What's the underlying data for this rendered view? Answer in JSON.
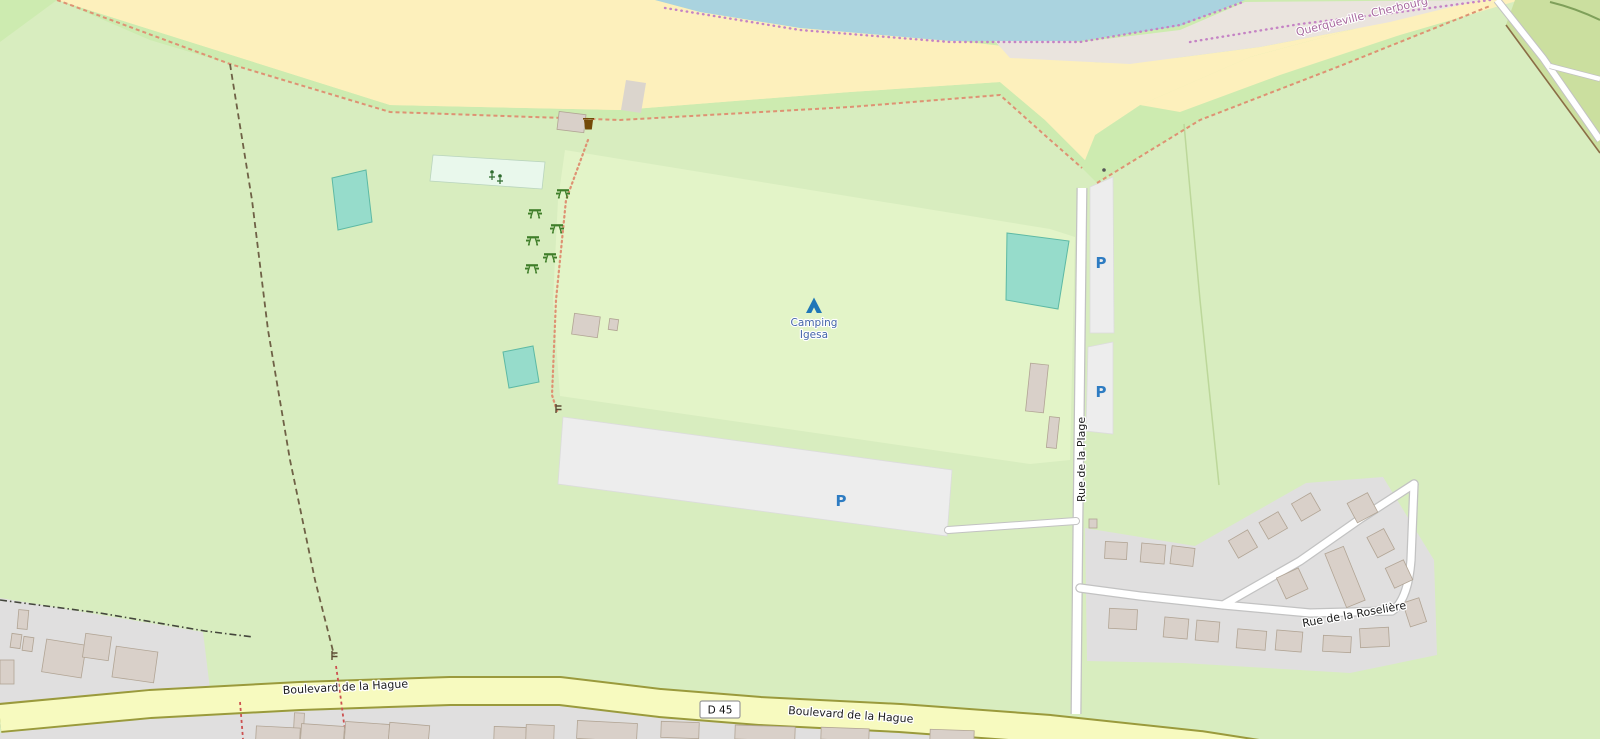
{
  "map": {
    "labels": {
      "querqueville": "Querqueville",
      "cherbourg": "Cherbourg",
      "camping_line1": "Camping",
      "camping_line2": "Igesa",
      "rue_plage": "Rue de la Plage",
      "rue_roseliere": "Rue de la Roselière",
      "blvd_hague_west": "Boulevard de la Hague",
      "blvd_hague_east": "Boulevard de la Hague",
      "route_ref": "D 45",
      "parking": "P"
    },
    "icons": {
      "campsite": "tent-icon",
      "picnic": "picnic-table-icon",
      "playground": "playground-icon",
      "waste": "waste-basket-icon",
      "gate": "gate-icon"
    },
    "colors": {
      "water": "#aad3df",
      "sand": "#fdf0bc",
      "shingle": "#eae4de",
      "grass": "#cdebb0",
      "field": "#d8edbf",
      "campsite": "#e3f4c8",
      "farmland": "#cbdf9f",
      "residential": "#e0dfdf",
      "building": "#d9d0c9",
      "parking": "#ededed",
      "playground": "#e9f8ec",
      "pool": "#96dccb",
      "road_secondary": "#f7fabf",
      "parking_blue": "#2e7cc2",
      "tourism_blue": "#2077b8",
      "boundary_purple": "#c583c5",
      "path_orange": "#de9273"
    }
  }
}
